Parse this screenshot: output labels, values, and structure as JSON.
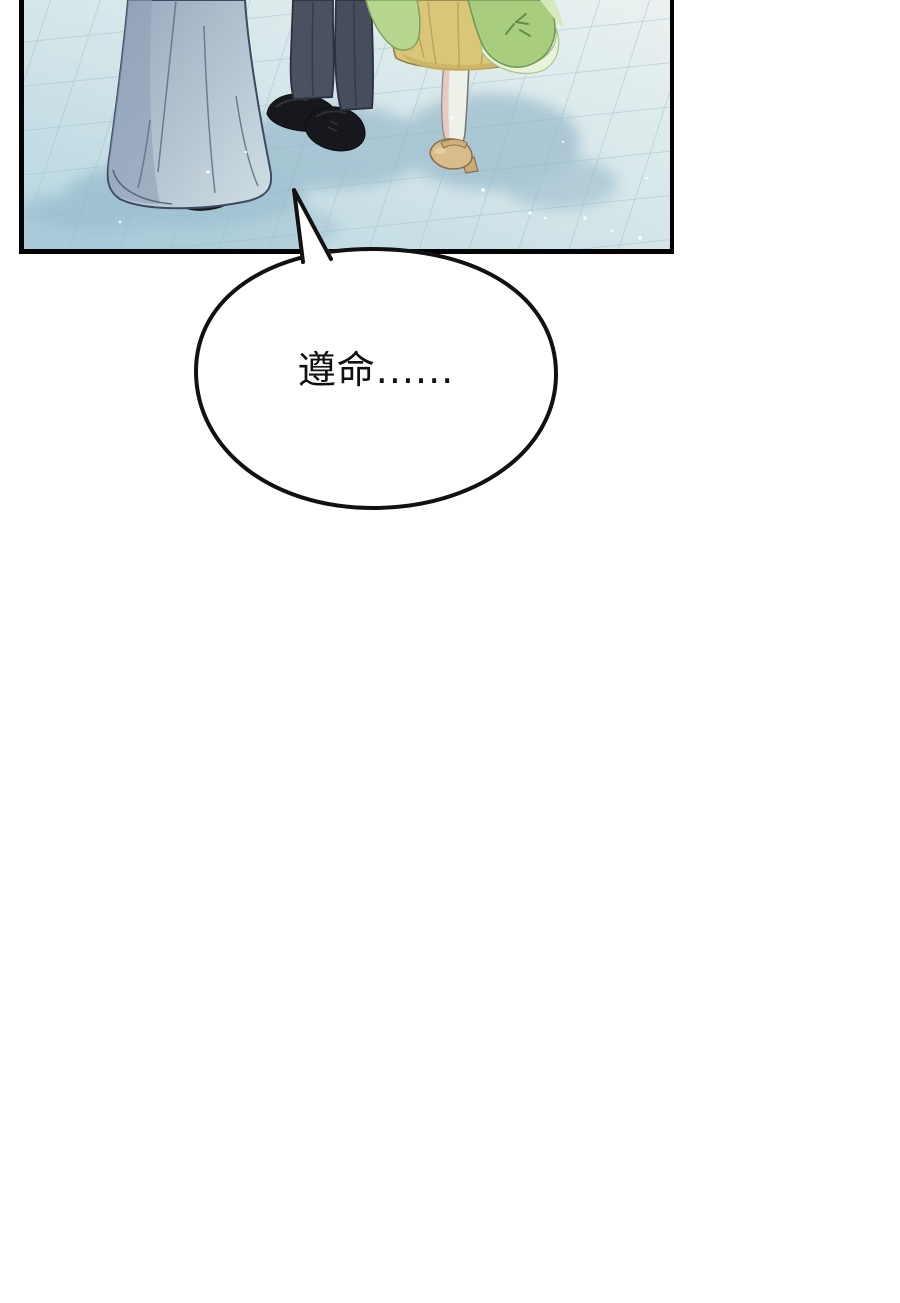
{
  "scene": {
    "type": "webtoon-page",
    "description_visible_text_only": true
  },
  "speech_bubble": {
    "text": "遵命......",
    "fill": "#ffffff",
    "stroke": "#111111",
    "text_color": "#111111"
  },
  "panel": {
    "border_color": "#000000",
    "floor": {
      "base_light": "#e9f1f0",
      "base_mid": "#d2e4e8",
      "base_dark": "#b5d6e2",
      "tile_line": "#a7c4cd",
      "shadow": "#8fb4c8",
      "sparkle": "#ffffff"
    },
    "characters": {
      "gown": {
        "light": "#cddce2",
        "dark": "#97a5bb",
        "outline": "#3c4a63",
        "shoe": "#262130"
      },
      "suit": {
        "trousers": "#4a5160",
        "trousers_alt": "#464d5c",
        "crease": "#343b4a",
        "outline": "#2c3140",
        "shoes": "#17181d"
      },
      "girl": {
        "skirt": "#d9c678",
        "skirt_shade": "#c9b164",
        "skirt_outline": "#8f7c45",
        "drape_pale": "#e9f3dc",
        "drape_mid": "#b7d68e",
        "drape_deep": "#a9cd7f",
        "leaf": "#5f8f45",
        "stocking": "#eef0ea",
        "stocking_shade": "#e6bfb4",
        "shoe": "#d9bc8c",
        "shoe_outline": "#8a6f46"
      }
    }
  }
}
